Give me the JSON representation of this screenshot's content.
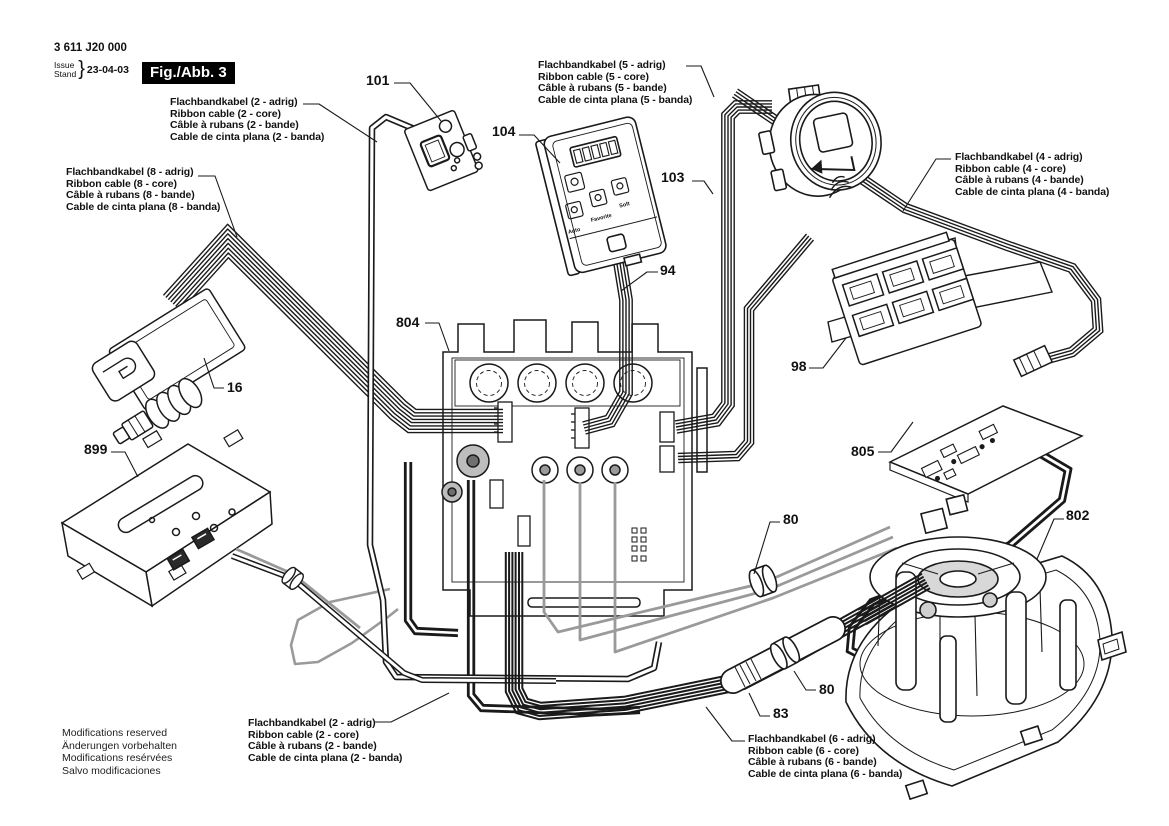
{
  "doc": {
    "part_number": "3 611 J20 000",
    "issue_label": "Issue",
    "stand_label": "Stand",
    "brace": "}",
    "date": "23-04-03",
    "figure_label": "Fig./Abb. 3"
  },
  "cable_labels": {
    "c2_top": [
      "Flachbandkabel (2 - adrig)",
      "Ribbon cable (2 - core)",
      "Câble à rubans (2 - bande)",
      "Cable de cinta plana (2 - banda)"
    ],
    "c8": [
      "Flachbandkabel (8 - adrig)",
      "Ribbon cable (8 - core)",
      "Câble à rubans (8 - bande)",
      "Cable de cinta plana (8 - banda)"
    ],
    "c5": [
      "Flachbandkabel (5 - adrig)",
      "Ribbon cable (5 - core)",
      "Câble à rubans (5 - bande)",
      "Cable de cinta plana (5 - banda)"
    ],
    "c4": [
      "Flachbandkabel (4 - adrig)",
      "Ribbon cable (4 - core)",
      "Câble à rubans (4 - bande)",
      "Cable de cinta plana (4 - banda)"
    ],
    "c2_bottom": [
      "Flachbandkabel (2 - adrig)",
      "Ribbon cable (2 - core)",
      "Câble à rubans (2 - bande)",
      "Cable de cinta plana (2 - banda)"
    ],
    "c6": [
      "Flachbandkabel (6 - adrig)",
      "Ribbon cable (6 - core)",
      "Câble à rubans (6 - bande)",
      "Cable de cinta plana (6 - banda)"
    ]
  },
  "part_numbers": {
    "control_switch": "101",
    "control_panel": "104",
    "dial": "103",
    "panel_cable": "94",
    "main_board": "804",
    "valve": "16",
    "mounting_plate": "899",
    "terminal_block": "98",
    "pcb": "805",
    "grommet_upper": "80",
    "motor": "802",
    "grommet_lower": "80",
    "sleeve": "83"
  },
  "panel": {
    "buttons": [
      "Auto",
      "Favorite",
      "Soft"
    ]
  },
  "footer": [
    "Modifications reserved",
    "Änderungen vorbehalten",
    "Modifications resérvées",
    "Salvo modificaciones"
  ],
  "colors": {
    "line": "#1a1a1a",
    "gray_wire": "#9a9a9a",
    "background": "#ffffff"
  }
}
